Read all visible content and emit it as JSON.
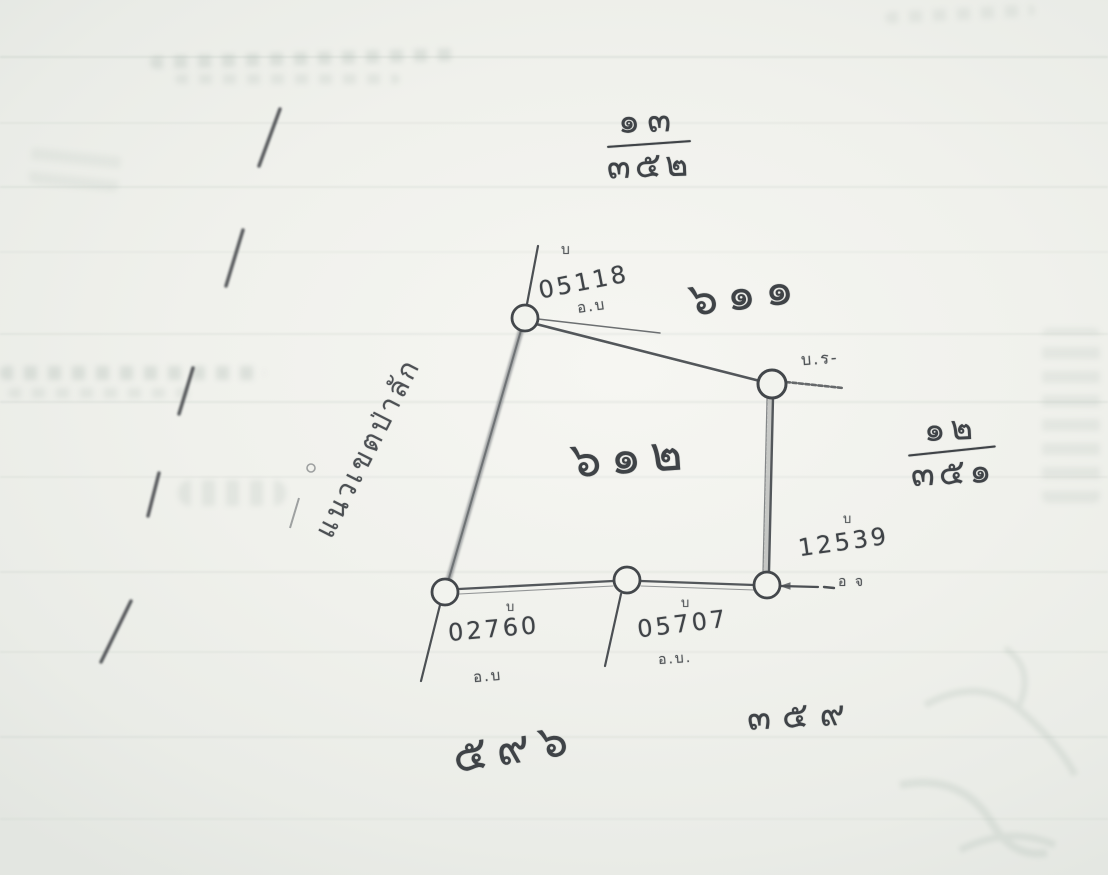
{
  "annotations": {
    "top_fraction": {
      "num": "๑๓",
      "den": "๓๕๒"
    },
    "right_fraction": {
      "num": "๑๒",
      "den": "๓๕๑"
    },
    "parcel_label_611": "๖๑๑",
    "parcel_label_612": "๖๑๒",
    "parcel_label_596": "๕๙๖",
    "parcel_label_359": "๓๕๙",
    "boundary_label": "แนวเขตป่าลัก",
    "corner_note": "บ.ร-"
  },
  "markers": [
    {
      "id": "top",
      "tag": "บ",
      "number": "05118",
      "note": "อ.บ"
    },
    {
      "id": "bottom-left",
      "tag": "บ",
      "number": "02760",
      "note": "อ.บ"
    },
    {
      "id": "bottom-middle",
      "tag": "บ",
      "number": "05707",
      "note": "อ.บ."
    },
    {
      "id": "right",
      "tag": "บ",
      "number": "12539",
      "note": "อ จ"
    }
  ]
}
